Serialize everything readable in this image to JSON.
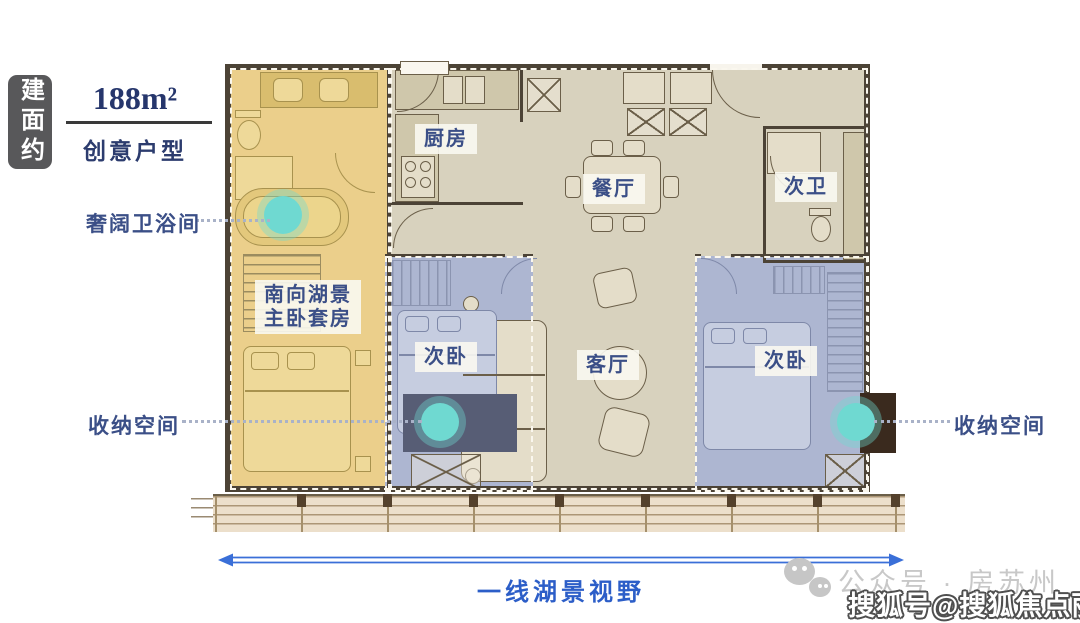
{
  "header": {
    "badge": "建面约",
    "area": "188m²",
    "subtitle": "创意户型"
  },
  "callouts": {
    "bath": "奢阔卫浴间",
    "storage_left": "收纳空间",
    "storage_right": "收纳空间"
  },
  "rooms": {
    "kitchen": "厨房",
    "dining": "餐厅",
    "second_bath": "次卫",
    "living": "客厅",
    "bedroom_mid": "次卧",
    "bedroom_right": "次卧",
    "master_line1": "南向湖景",
    "master_line2": "主卧套房"
  },
  "footer": {
    "view": "一线湖景视野"
  },
  "watermark": {
    "wechat_account": "公众号 · 房苏州",
    "sohu_account": "搜狐号@搜狐焦点丽水站"
  },
  "colors": {
    "accent_blue": "#3a6fd8",
    "label_navy": "#3b4f87",
    "highlight_teal": "#6fd9d1",
    "suite_yellow": "#ebcf8b",
    "bedroom_blue": "#adb6d1",
    "floor_beige": "#d8d2be",
    "wall_brown": "#4c4336",
    "badge_gray": "#58585a"
  }
}
